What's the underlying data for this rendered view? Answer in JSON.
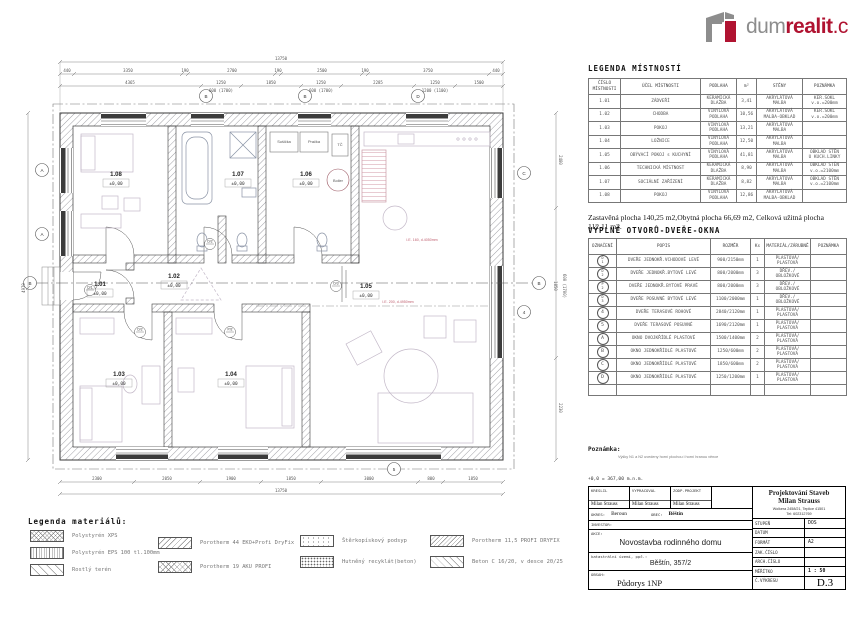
{
  "logo": {
    "part1": "dum",
    "part2": "realit",
    "part3": ".cz"
  },
  "colors": {
    "logo_gray": "#8d8d8d",
    "logo_red": "#b01331",
    "wall_line": "#3a3a3a",
    "furniture": "#c3b8c8",
    "utility_pink": "#c06070"
  },
  "plan": {
    "rooms": [
      {
        "id": "1.01",
        "elev": "±0,00"
      },
      {
        "id": "1.02",
        "elev": "±0,00"
      },
      {
        "id": "1.03",
        "elev": "±0,00"
      },
      {
        "id": "1.04",
        "elev": "±0,00"
      },
      {
        "id": "1.05",
        "elev": "±0,00"
      },
      {
        "id": "1.06",
        "elev": "±0,00"
      },
      {
        "id": "1.07",
        "elev": "±0,00"
      },
      {
        "id": "1.08",
        "elev": "±0,00"
      }
    ],
    "appliances": {
      "susicka": "Sušička",
      "pracka": "Pračka",
      "tc": "TČ",
      "boiler": "Boiler"
    },
    "door_marks": [
      "D/1",
      "D/2",
      "P/2",
      "D/3",
      "D/2"
    ],
    "window_marks": [
      "B",
      "B",
      "D",
      "A",
      "A",
      "C",
      "4",
      "5"
    ],
    "section_mark": "B",
    "utility_labels": [
      "I.E. 160, d.4050mm",
      "I.E. 200, d.4950mm"
    ],
    "dims": {
      "top_total": "13750",
      "top_chain": [
        "440",
        "3350",
        "190",
        "2700",
        "190",
        "2500",
        "190",
        "3750",
        "440"
      ],
      "mid_chain": [
        "4365",
        "1250",
        "1850",
        "1250",
        "2285",
        "1250",
        "1500"
      ],
      "mid_sub": [
        "600 (1700)",
        "600 (1700)",
        "1200 (1100)"
      ],
      "bottom_chain": [
        "2300",
        "2050",
        "1900",
        "1850",
        "3000",
        "800",
        "1850"
      ],
      "bottom_total": "13750",
      "left_label": "4970",
      "right_labels": [
        "2480",
        "1850",
        "600 (1700)",
        "2230"
      ]
    }
  },
  "room_legend": {
    "title": "LEGENDA MÍSTNOSTÍ",
    "headers": [
      "ČÍSLO\nMÍSTNOSTI",
      "ÚČEL MÍSTNOSTI",
      "PODLAHA",
      "m²",
      "STĚNY",
      "POZNÁMKA"
    ],
    "rows": [
      [
        "1.01",
        "ZÁDVEŘÍ",
        "KERAMICKÁ\nDLAŽBA",
        "3,41",
        "AKRYLÁTOVÁ\nMALBA",
        "KER.SOKL\nv.o.=200mm"
      ],
      [
        "1.02",
        "CHODBA",
        "VINYLOVÁ\nPODLAHA",
        "10,56",
        "AKRYLÁTOVÁ\nMALBA-OBKLAD",
        "KER.SOKL\nv.o.=200mm"
      ],
      [
        "1.03",
        "POKOJ",
        "VINYLOVÁ\nPODLAHA",
        "13,21",
        "AKRYLÁTOVÁ\nMALBA",
        ""
      ],
      [
        "1.04",
        "LOŽNICE",
        "VINYLOVÁ\nPODLAHA",
        "12,50",
        "AKRYLÁTOVÁ\nMALBA",
        ""
      ],
      [
        "1.05",
        "OBÝVACÍ POKOJ s KUCHYNÍ",
        "VINYLOVÁ\nPODLAHA",
        "41,81",
        "AKRYLÁTOVÁ\nMALBA",
        "OBKLAD STĚN\nU KUCH.LINKY"
      ],
      [
        "1.06",
        "TECHNICKÁ MÍSTNOST",
        "KERAMICKÁ\nDLAŽBA",
        "8,90",
        "AKRYLÁTOVÁ\nMALBA",
        "OBKLAD STĚN\nv.o.=2100mm"
      ],
      [
        "1.07",
        "SOCIÁLNÍ ZAŘÍZENÍ",
        "KERAMICKÁ\nDLAŽBA",
        "8,82",
        "AKRYLÁTOVÁ\nMALBA",
        "OBKLAD STĚN\nv.o.=2100mm"
      ],
      [
        "1.08",
        "POKOJ",
        "VINYLOVÁ\nPODLAHA",
        "12,86",
        "AKRYLÁTOVÁ\nMALBA-OBKLAD",
        ""
      ]
    ]
  },
  "area_summary": "Zastavěná plocha 140,25 m2,Obytná plocha 66,69 m2, Celková užitná plocha 112,11 m2.",
  "openings": {
    "title": "VÝPLNĚ  OTVORŮ-DVEŘE-OKNA",
    "headers": [
      "OZNAČENÍ",
      "POPIS",
      "ROZMĚR",
      "Ks",
      "MATERIÁL/ZÁRUBNĚ",
      "POZNÁMKA"
    ],
    "trailing_empty_row": true,
    "rows": [
      {
        "mark": "D/1",
        "cells": [
          "DVEŘE JEDNOKŘ.VCHODOVÉ LEVÉ",
          "900/2150mm",
          "1",
          "PLASTOVÁ/\nPLASTOVÁ",
          ""
        ]
      },
      {
        "mark": "D/2",
        "cells": [
          "DVEŘE JEDNOKŘ.BYTOVÉ LEVÉ",
          "800/2000mm",
          "3",
          "DŘEV./\nOBLOŽKOVÉ",
          ""
        ]
      },
      {
        "mark": "P/2",
        "cells": [
          "DVEŘE JEDNOKŘ.BYTOVÉ PRAVÉ",
          "800/2000mm",
          "3",
          "DŘEV./\nOBLOŽKOVÉ",
          ""
        ]
      },
      {
        "mark": "D/3",
        "cells": [
          "DVEŘE POSUVNÉ BYTOVÉ LEVÉ",
          "1100/2000mm",
          "1",
          "DŘEV./\nOBLOŽKOVÉ",
          ""
        ]
      },
      {
        "mark": "4",
        "cells": [
          "DVEŘE TERASOVÉ ROHOVÉ",
          "2840/2120mm",
          "1",
          "PLASTOVÁ/\nPLASTOVÁ",
          ""
        ]
      },
      {
        "mark": "5",
        "cells": [
          "DVEŘE TERASOVÉ POSUVNÉ",
          "1690/2120mm",
          "1",
          "PLASTOVÁ/\nPLASTOVÁ",
          ""
        ]
      },
      {
        "mark": "A",
        "cells": [
          "OKNO DVOJKŘÍDLÉ PLASTOVÉ",
          "1500/1400mm",
          "2",
          "PLASTOVÁ/\nPLASTOVÁ",
          ""
        ]
      },
      {
        "mark": "B",
        "cells": [
          "OKNO JEDNOKŘÍDLÉ PLASTOVÉ",
          "1250/600mm",
          "2",
          "PLASTOVÁ/\nPLASTOVÁ",
          ""
        ]
      },
      {
        "mark": "C",
        "cells": [
          "OKNO JEDNOKŘÍDLÉ PLASTOVÉ",
          "1850/600mm",
          "2",
          "PLASTOVÁ/\nPLASTOVÁ",
          ""
        ]
      },
      {
        "mark": "D",
        "cells": [
          "OKNO JEDNOKŘÍDLÉ PLASTOVÉ",
          "1250/1200mm",
          "1",
          "PLASTOVÁ/\nPLASTOVÁ",
          ""
        ]
      }
    ]
  },
  "note": {
    "label": "Poznámka:",
    "text": "Výšky N1 a N2 uvedeny horní plochou i horní hranou věnce"
  },
  "datum_line": "+0,0 = 367,00 m.n.m.",
  "materials_legend": {
    "title": "Legenda materiálů:",
    "columns": [
      [
        {
          "label": "Polystyrén XPS",
          "pattern": "xps"
        },
        {
          "label": "Polystyrén EPS 100 tl.100mm",
          "pattern": "eps"
        },
        {
          "label": "Rostlý terén",
          "pattern": "teren"
        }
      ],
      [
        {
          "label": "Porotherm 44 EKO+Profi DryFix",
          "pattern": "p44"
        },
        {
          "label": "Porotherm 19 AKU PROFI",
          "pattern": "p19"
        }
      ],
      [
        {
          "label": "Štěrkopískový podsyp",
          "pattern": "podsyp"
        },
        {
          "label": "Hutněný recyklát(beton)",
          "pattern": "recyklat"
        }
      ],
      [
        {
          "label": "Porotherm 11,5 PROFI DRYFIX",
          "pattern": "p115"
        },
        {
          "label": "Beton C 16/20, v desce 20/25",
          "pattern": "beton"
        }
      ]
    ]
  },
  "title_block": {
    "people": [
      {
        "label": "KRESLIL",
        "name": "Milan Strauss"
      },
      {
        "label": "VYPRACOVAL",
        "name": "Milan Strauss"
      },
      {
        "label": "ZODP.PROJEKT",
        "name": "Milan Strauss"
      }
    ],
    "company": {
      "line1": "Projektování Staveb",
      "line2": "Milan Strauss",
      "addr1": "Wolkera 2458/21, Teplice 41501",
      "addr2": "Tel: 602312769"
    },
    "okres_label": "OKRES:",
    "okres": "Beroun",
    "obec_label": "OBEC:",
    "obec": "Běštín",
    "investor_label": "INVESTOR:",
    "akce_label": "AKCE:",
    "akce": "Novostavba rodinného domu",
    "kat_label": "katastrální území, ppč.:",
    "kat": "Běštín, 357/2",
    "obsah_label": "OBSAH:",
    "obsah": "Půdorys 1NP",
    "meta": [
      {
        "label": "STUPEŇ",
        "value": "DOS"
      },
      {
        "label": "DATUM",
        "value": ""
      },
      {
        "label": "FORMÁT",
        "value": "A2"
      },
      {
        "label": "ZAK.ČÍSLO",
        "value": ""
      },
      {
        "label": "ARCH.ČÍSLO",
        "value": ""
      },
      {
        "label": "MĚŘÍTKO",
        "value": "1 : 50"
      }
    ],
    "drawing_no_label": "Č.VÝKRESU",
    "drawing_no": "D.3"
  }
}
